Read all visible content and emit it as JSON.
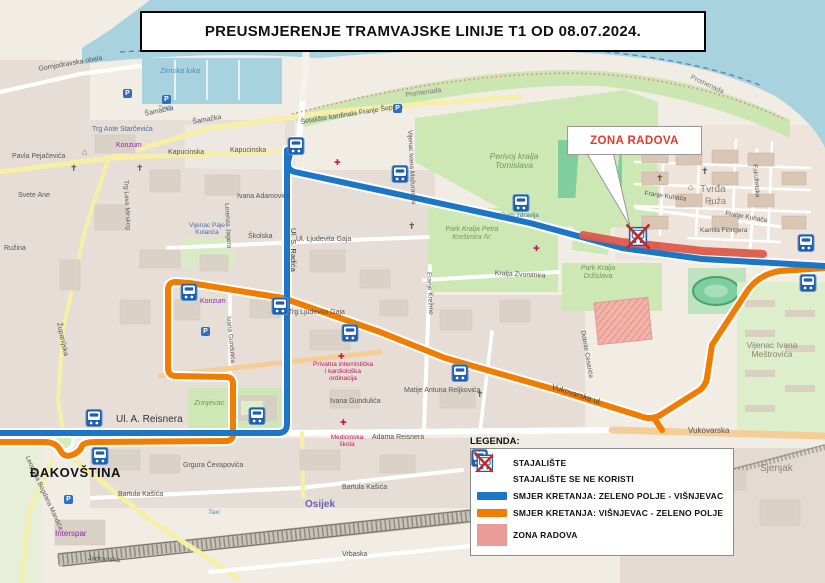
{
  "header": {
    "title": "PREUSMJERENJE TRAMVAJSKE LINIJE T1 OD 08.07.2024."
  },
  "callout": {
    "text": "ZONA RADOVA"
  },
  "legend": {
    "heading": "LEGENDA:",
    "items": [
      {
        "type": "stop-icon",
        "label": "STAJALIŠTE"
      },
      {
        "type": "stop-crossed-icon",
        "label": "STAJALIŠTE SE NE KORISTI"
      },
      {
        "type": "line-blue",
        "label": "SMJER KRETANJA: ZELENO POLJE - VIŠNJEVAC"
      },
      {
        "type": "line-orange",
        "label": "SMJER KRETANJA: VIŠNJEVAC - ZELENO POLJE"
      },
      {
        "type": "zone-pink",
        "label": "ZONA RADOVA"
      }
    ]
  },
  "colors": {
    "route_blue": "#1C76C5",
    "route_orange": "#F07D00",
    "work_zone_track_red": "#DC5A4A",
    "work_zone_pink": "#EA9C96",
    "callout_red": "#E23B2E",
    "water": "#A9D2DF",
    "park_green": "#CDE8B5"
  },
  "map": {
    "icons": {
      "church": "✝",
      "parking": "P",
      "museum": "⌂",
      "medical": "✚"
    },
    "labels": [
      "ĐAKOVŠTINA",
      "Ul. A. Reisnera",
      "Adama Reisnera",
      "Vukovarska ul.",
      "Vukovarska",
      "Vijenac Ivana Meštrovića",
      "Perivoj kralja Tomislava",
      "Park Kralja Petra Krešimira IV.",
      "Park Kralja Držislava",
      "Tvrđa",
      "Promenada",
      "Šetalište kardinala Franje Šepera",
      "Šamačka",
      "Kapucinska",
      "Trg Ante Starčevića",
      "Konzum",
      "Zimska luka",
      "Gornjodravska obala",
      "Ul. S. Radića",
      "Ul. Ljudevita Gaja",
      "Trg Ljudevita Gaja",
      "Školska",
      "Ivana Adamovića",
      "Županijska",
      "Ivana Gundulića",
      "Matije Antuna Reljkovića",
      "Zrinjevac",
      "Grgura Čevapovića",
      "Leopolda Bogdana Mandića",
      "Interspar",
      "Bartula Kašića",
      "Osijek",
      "Jadranska",
      "Vrbaska",
      "Sjenjak",
      "Kralja Zvonimira",
      "Franje Kuhača",
      "Kamila Firingera",
      "Fakultetska",
      "Dom zdravlja",
      "Pavla Pejačevića",
      "Svete Ane",
      "Ružina",
      "Trg Lava Mirskog",
      "Vijenac Paje Kolarića",
      "Lorenza Jagera",
      "Vijenac Ivana Mažuranića",
      "Konzum",
      "Medicinska škola",
      "Privatna internistička i kardiološka ordinacija",
      "Franje Krežme",
      "Dobrile Cesarića",
      "Taxi",
      "Promenada",
      "Šamačka",
      "Kapucinska",
      "Ivana Gundulića",
      "Bartula Kašića",
      "Franje Kuhača",
      "Ruža",
      "Tvrđa"
    ]
  }
}
